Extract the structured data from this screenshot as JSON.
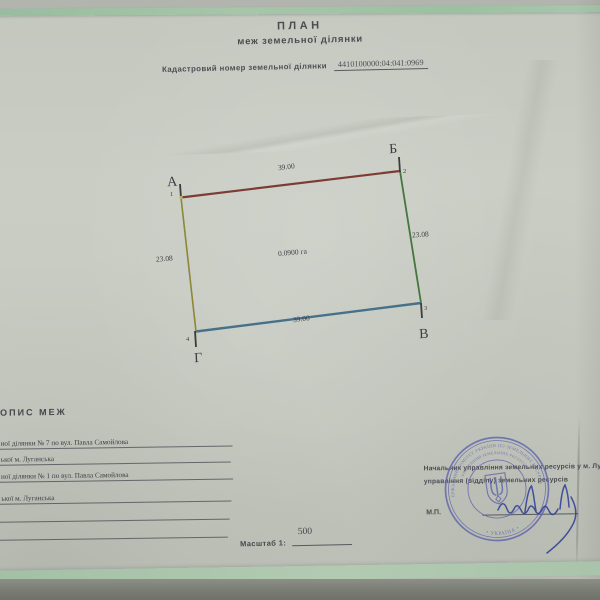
{
  "header": {
    "title": "ПЛАН",
    "subtitle": "меж земельної ділянки",
    "cadastral_label": "Кадастровий номер земельної ділянки",
    "cadastral_number": "4410100000:04:041:0969"
  },
  "plan": {
    "area": "0.0900 га",
    "corners": [
      {
        "letter": "А",
        "point": "1"
      },
      {
        "letter": "Б",
        "point": "2"
      },
      {
        "letter": "В",
        "point": "3"
      },
      {
        "letter": "Г",
        "point": "4"
      }
    ],
    "sides": [
      {
        "edge": "А-Б",
        "length": "39.00",
        "color": "#7c3c34"
      },
      {
        "edge": "Б-В",
        "length": "23.08",
        "color": "#45763e"
      },
      {
        "edge": "Г-В",
        "length": "39.00",
        "color": "#47708a"
      },
      {
        "edge": "А-Г",
        "length": "23.08",
        "color": "#8d8735"
      }
    ]
  },
  "boundaries": {
    "heading": "ОПИС МЕЖ",
    "lines": [
      "ної ділянки № 7 по вул. Павла Самойлова",
      "ької м. Луганська",
      "ної ділянки № 1 по вул. Павла Самойлова",
      "ької м. Луганська",
      "",
      ""
    ]
  },
  "scale": {
    "label": "Масштаб 1:",
    "value": "500"
  },
  "approval": {
    "line1": "Начальник управління земельних ресурсів у м. Луг",
    "line2": "управління (відділу) земельних ресурсів",
    "seal_mark": "М.П."
  },
  "stamp": {
    "arc_top": "ДЕРЖАВНИЙ КОМІТЕТ УКРАЇНИ ПО ЗЕМЕЛЬНИХ РЕСУРСАХ",
    "arc_mid": "УПРАВЛІННЯ ЗЕМЕЛЬНИХ РЕСУРСІВ",
    "arc_bottom": "• УКРАЇНА •",
    "color": "#5d61ab"
  }
}
